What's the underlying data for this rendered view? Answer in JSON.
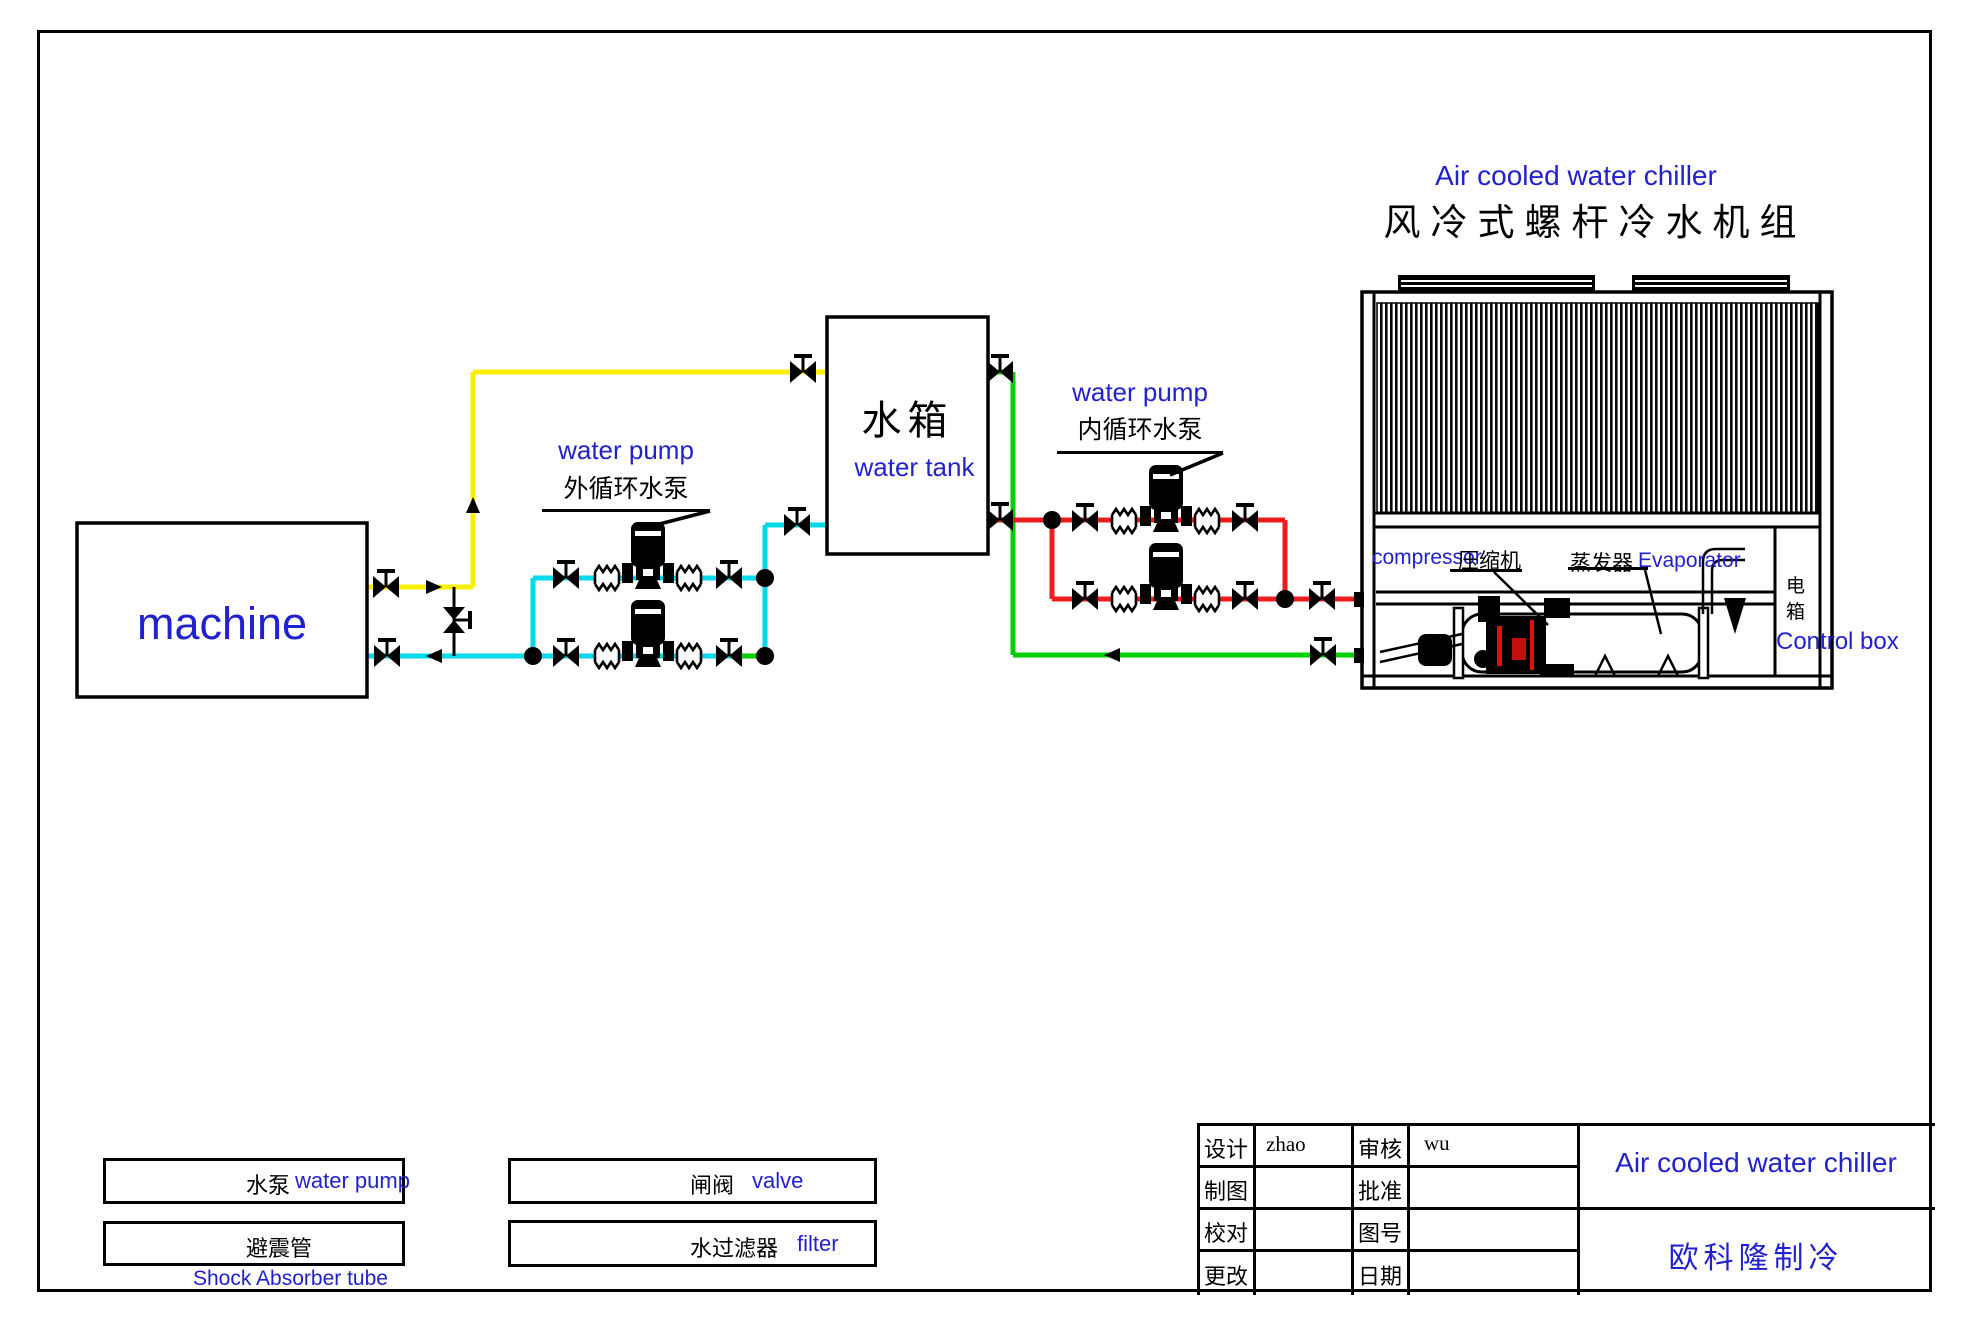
{
  "page_title": {
    "en": "Air cooled water chiller",
    "zh": "风冷式螺杆冷水机组"
  },
  "machine_label": "machine",
  "tank": {
    "zh": "水箱",
    "en": "water tank"
  },
  "external_pump": {
    "en": "water pump",
    "zh": "外循环水泵"
  },
  "internal_pump": {
    "en": "water pump",
    "zh": "内循环水泵"
  },
  "chiller": {
    "compressor_en": "compressor",
    "compressor_zh": "压缩机",
    "evaporator_zh": "蒸发器",
    "evaporator_en": "Evaporator",
    "control_box_zh": "电箱",
    "control_box_en": "Control box"
  },
  "legend": {
    "pump_zh": "水泵",
    "pump_en": "water pump",
    "shock_zh": "避震管",
    "shock_en": "Shock Absorber tube",
    "valve_zh": "闸阀",
    "valve_en": "valve",
    "filter_zh": "水过滤器",
    "filter_en": "filter"
  },
  "title_block": {
    "design": "设计",
    "design_val": "zhao",
    "audit": "审核",
    "audit_val": "wu",
    "draft": "制图",
    "approve": "批准",
    "proof": "校对",
    "fig_no": "图号",
    "change": "更改",
    "date": "日期",
    "product": "Air cooled water chiller",
    "company": "欧科隆制冷"
  },
  "colors": {
    "blue": "#2121cd",
    "yellow": "#f7ef00",
    "cyan": "#00d9ea",
    "green": "#00cf00",
    "red": "#ee1c1c"
  }
}
